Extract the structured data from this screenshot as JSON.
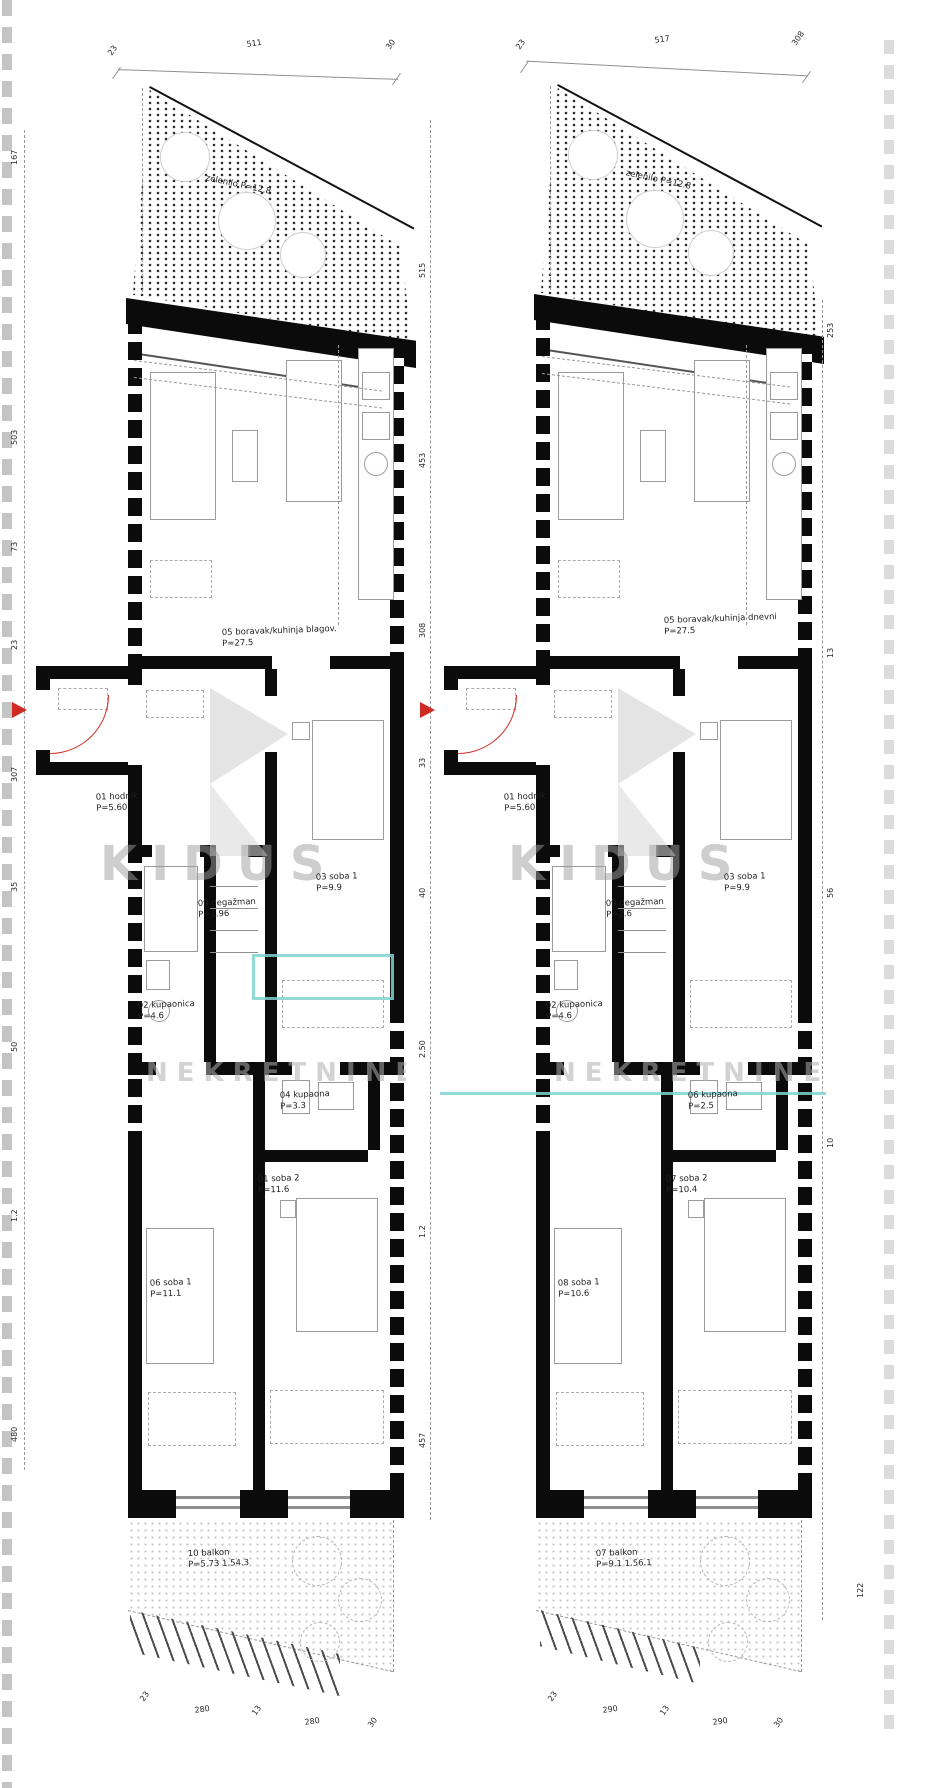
{
  "watermark": {
    "word_left": "KIDUS",
    "word_right": "KIDUS",
    "subtitle_left": "NEKRETNINE",
    "subtitle_right": "NEKRETNINE",
    "accent_color": "#7fd4cf"
  },
  "plans": {
    "left": {
      "roof": {
        "label": "zelenilo",
        "area": "P=12.8"
      },
      "rooms": {
        "living": {
          "label": "05 boravak/kuhinja blagov.",
          "area": "P=27.5"
        },
        "hall": {
          "label": "01 hodnik",
          "area": "P=5.60"
        },
        "degazman": {
          "label": "09 degažman",
          "area": "P=1.96"
        },
        "soba1": {
          "label": "03 soba 1",
          "area": "P=9.9"
        },
        "bath": {
          "label": "02 kupaonica",
          "area": "P=4.6"
        },
        "wc": {
          "label": "04 kupaona",
          "area": "P=3.3"
        },
        "soba2": {
          "label": "01 soba 2",
          "area": "P=11.6"
        },
        "soba3": {
          "label": "06 soba 1",
          "area": "P=11.1"
        },
        "balcony": {
          "label": "10 balkon",
          "area": "P=5.73 1.54.3"
        }
      },
      "dims": {
        "top": [
          "23",
          "511",
          "30"
        ],
        "side": [
          "167",
          "503",
          "73",
          "23",
          "307",
          "35",
          "50",
          "1.2",
          "480"
        ],
        "bottom": [
          "23",
          "280",
          "13",
          "280",
          "30"
        ]
      }
    },
    "right": {
      "roof": {
        "label": "zelenilo",
        "area": "P=12.8"
      },
      "rooms": {
        "living": {
          "label": "05 boravak/kuhinja dnevni",
          "area": "P=27.5"
        },
        "hall": {
          "label": "01 hodnik",
          "area": "P=5.60"
        },
        "degazman": {
          "label": "09 degažman",
          "area": "P=2.6"
        },
        "soba1": {
          "label": "03 soba 1",
          "area": "P=9.9"
        },
        "bath": {
          "label": "02 kupaonica",
          "area": "P=4.6"
        },
        "wc": {
          "label": "06 kupaona",
          "area": "P=2.5"
        },
        "soba2": {
          "label": "07 soba 2",
          "area": "P=10.4"
        },
        "soba3": {
          "label": "08 soba 1",
          "area": "P=10.6"
        },
        "balcony": {
          "label": "07 balkon",
          "area": "P=9.1 1.56.1"
        }
      },
      "dims": {
        "top": [
          "23",
          "517",
          "308"
        ],
        "mid": [
          "515",
          "453",
          "308",
          "33",
          "40",
          "2.50",
          "1.2",
          "457"
        ],
        "bottom": [
          "23",
          "290",
          "13",
          "290",
          "30"
        ],
        "edge": [
          "253",
          "13",
          "56",
          "10",
          "122"
        ]
      }
    }
  }
}
